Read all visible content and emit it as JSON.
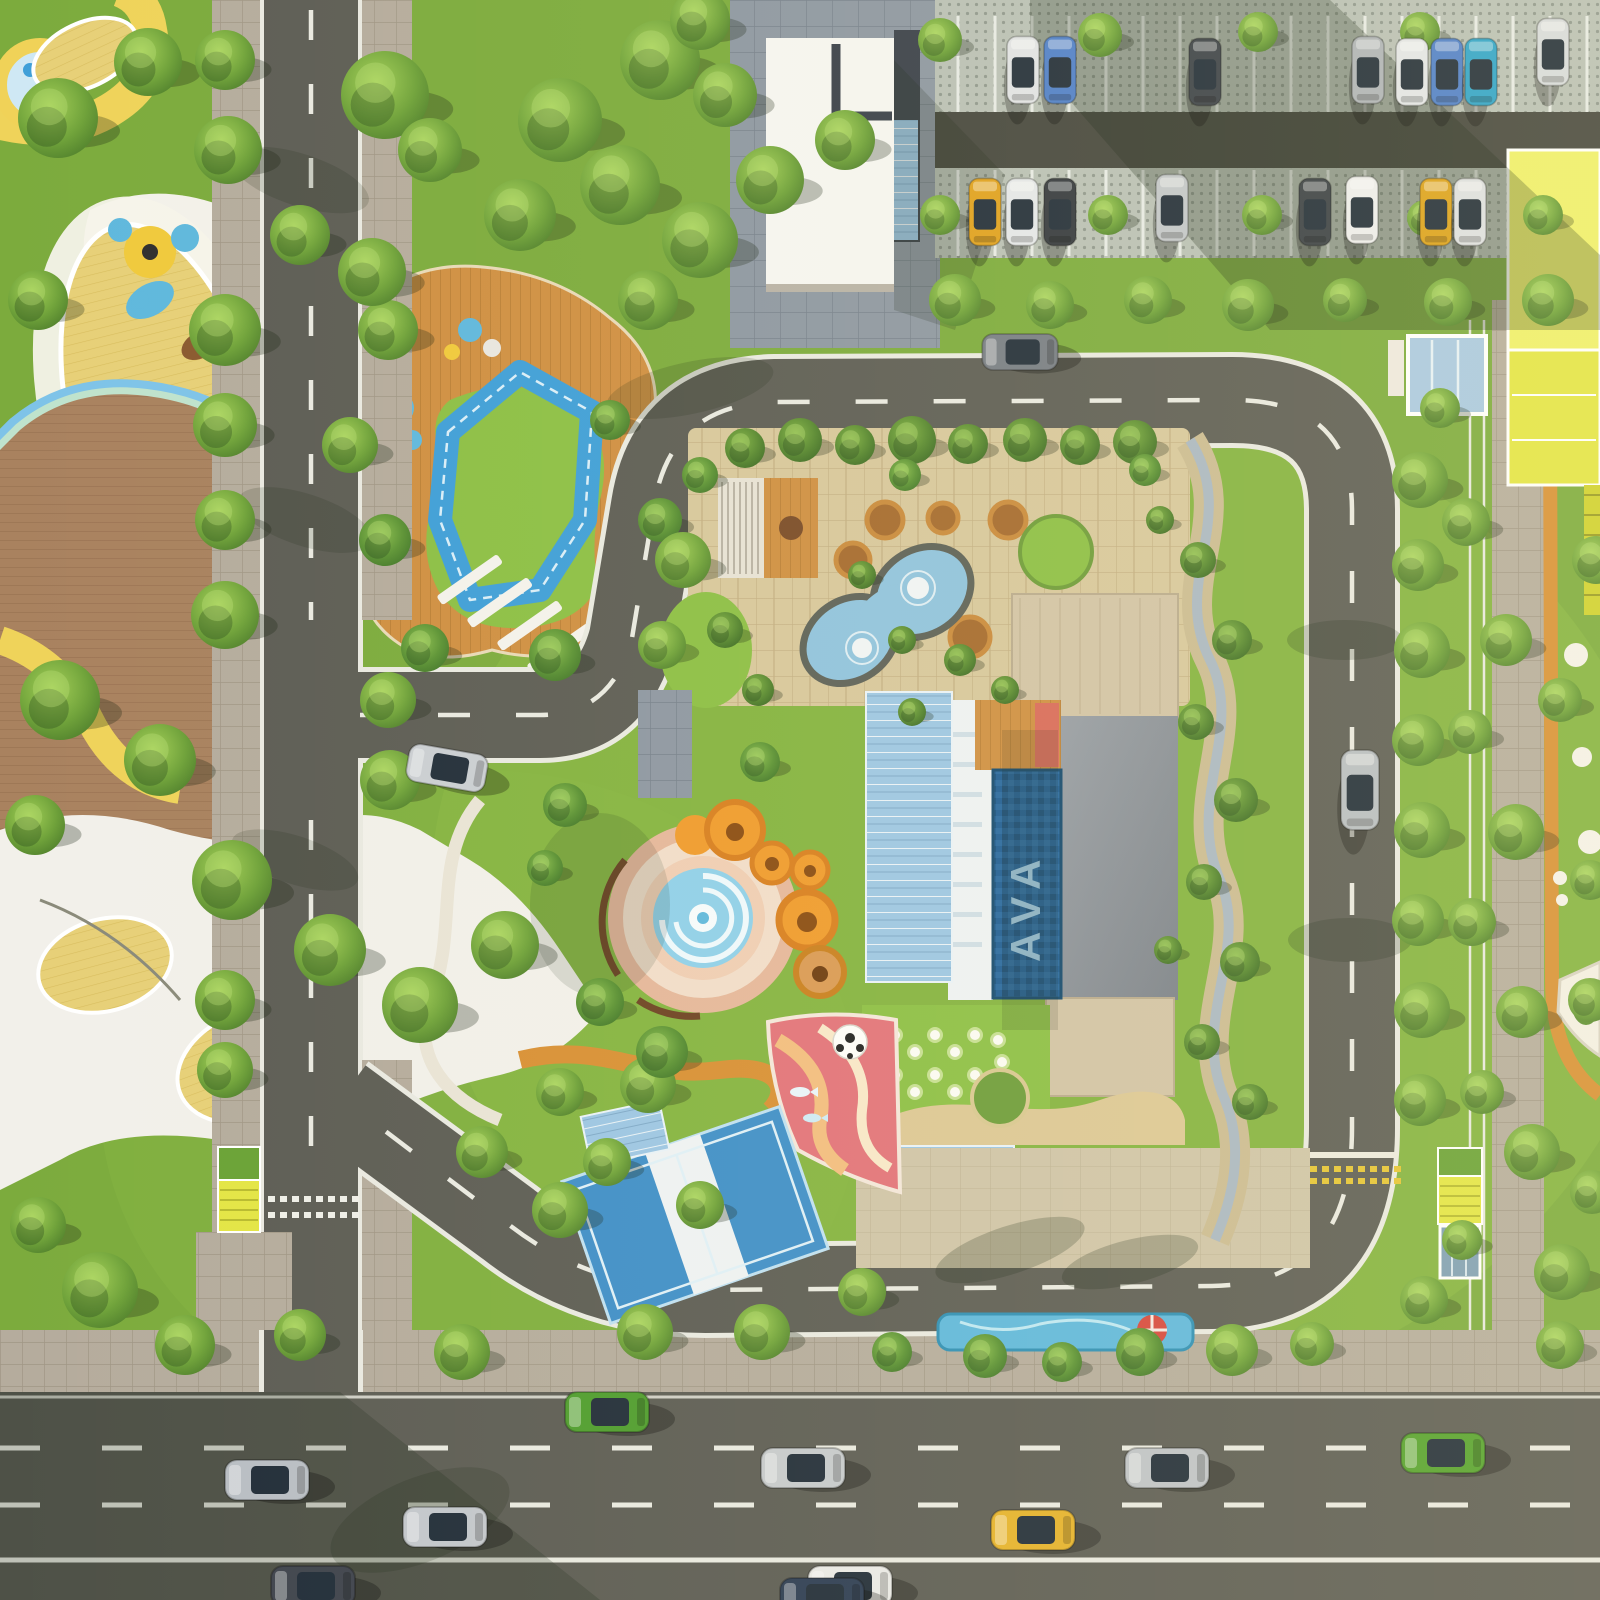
{
  "scene": {
    "type": "aerial-3d-render",
    "description": "Top-down aerial render of a residential amenity block: central clubhouse with lap pool and roof garden, spiral water plaza with orange canopies, kids playgrounds, sports court, loop road, street parking and a multi-lane highway at the bottom"
  },
  "pool": {
    "logo_text": "AVA"
  },
  "palette": {
    "grass": "#7cab3d",
    "grassLight": "#93c24a",
    "grassDark": "#55832e",
    "lawnBright": "#8cbf45",
    "asphalt": "#5d5d55",
    "asphaltDark": "#45463e",
    "roadLine": "#e9e9e1",
    "sidewalk": "#b5ac9d",
    "sidewalkLine": "#a09685",
    "coolPaver": "#8d97a2",
    "coolPaverLine": "#76808c",
    "permPaver": "#b9c0b6",
    "permDot": "#8f978e",
    "terrace": "#d7c79c",
    "terraceLine": "#c2ad81",
    "plaza": "#cfc4a8",
    "wood": "#cf8f42",
    "woodLine": "#b37a33",
    "deckBrown": "#a9825f",
    "deckLine": "#997252",
    "yellowWood": "#e7d078",
    "yellowWoodLine": "#d8bd5e",
    "white": "#f3f1ea",
    "poolDark": "#1e5d94",
    "poolMid": "#3f8fc9",
    "poolLight": "#8fc3de",
    "aqua": "#5fb8dd",
    "glass": "#9cc6e4",
    "trackBlue": "#3f9fd8",
    "orange": "#ef9b2d",
    "orangeDeep": "#d87f1f",
    "jog": "#d89035",
    "pinkRing": "#e5b79b",
    "pinkPale": "#f1ddca",
    "pinkDeep": "#e2737a",
    "sand": "#dcc795",
    "yellowPath": "#efd35a",
    "mint": "#bfe3cd",
    "canopyYellow": "#e3e545",
    "roofDark": "#39404a",
    "roofGray": "#8a9099",
    "roofBeige": "#d2c3a6",
    "red": "#d6483e"
  },
  "trees": [
    [
      58,
      118,
      40,
      0
    ],
    [
      148,
      62,
      34,
      0
    ],
    [
      38,
      300,
      30,
      0
    ],
    [
      225,
      60,
      30,
      0
    ],
    [
      228,
      150,
      34,
      0
    ],
    [
      385,
      95,
      44,
      0
    ],
    [
      300,
      235,
      30,
      0
    ],
    [
      225,
      330,
      36,
      0
    ],
    [
      388,
      330,
      30,
      0
    ],
    [
      225,
      425,
      32,
      0
    ],
    [
      225,
      520,
      30,
      0
    ],
    [
      385,
      540,
      26,
      2
    ],
    [
      225,
      615,
      34,
      0
    ],
    [
      60,
      700,
      40,
      0
    ],
    [
      160,
      760,
      36,
      0
    ],
    [
      35,
      825,
      30,
      0
    ],
    [
      232,
      880,
      40,
      0
    ],
    [
      330,
      950,
      36,
      0
    ],
    [
      225,
      1000,
      30,
      0
    ],
    [
      388,
      700,
      28,
      0
    ],
    [
      390,
      780,
      30,
      0
    ],
    [
      225,
      1070,
      28,
      0
    ],
    [
      100,
      1290,
      38,
      0
    ],
    [
      185,
      1345,
      30,
      0
    ],
    [
      38,
      1225,
      28,
      0
    ],
    [
      300,
      1335,
      26,
      0
    ],
    [
      420,
      1005,
      38,
      0
    ],
    [
      505,
      945,
      34,
      0
    ],
    [
      660,
      60,
      40,
      0
    ],
    [
      560,
      120,
      42,
      0
    ],
    [
      620,
      185,
      40,
      0
    ],
    [
      700,
      240,
      38,
      0
    ],
    [
      770,
      180,
      34,
      0
    ],
    [
      845,
      140,
      30,
      0
    ],
    [
      725,
      95,
      32,
      0
    ],
    [
      520,
      215,
      36,
      0
    ],
    [
      430,
      150,
      32,
      0
    ],
    [
      372,
      272,
      34,
      0
    ],
    [
      350,
      445,
      28,
      0
    ],
    [
      425,
      648,
      24,
      2
    ],
    [
      555,
      655,
      26,
      2
    ],
    [
      648,
      300,
      30,
      0
    ],
    [
      610,
      420,
      20,
      2
    ],
    [
      660,
      520,
      22,
      2
    ],
    [
      940,
      40,
      22,
      0
    ],
    [
      940,
      215,
      20,
      0
    ],
    [
      1100,
      35,
      22,
      0
    ],
    [
      1108,
      215,
      20,
      0
    ],
    [
      1258,
      32,
      20,
      0
    ],
    [
      1262,
      215,
      20,
      0
    ],
    [
      1420,
      32,
      20,
      0
    ],
    [
      1425,
      218,
      18,
      0
    ],
    [
      1543,
      215,
      20,
      0
    ],
    [
      955,
      300,
      26,
      0
    ],
    [
      1050,
      305,
      24,
      0
    ],
    [
      1148,
      300,
      24,
      0
    ],
    [
      1248,
      305,
      26,
      0
    ],
    [
      1345,
      300,
      22,
      0
    ],
    [
      1448,
      302,
      24,
      0
    ],
    [
      1548,
      300,
      26,
      0
    ],
    [
      700,
      20,
      30,
      0
    ],
    [
      745,
      448,
      20,
      1
    ],
    [
      800,
      440,
      22,
      1
    ],
    [
      855,
      445,
      20,
      1
    ],
    [
      912,
      440,
      24,
      1
    ],
    [
      968,
      444,
      20,
      1
    ],
    [
      1025,
      440,
      22,
      1
    ],
    [
      1080,
      445,
      20,
      1
    ],
    [
      1135,
      442,
      22,
      1
    ],
    [
      683,
      560,
      28,
      0
    ],
    [
      662,
      645,
      24,
      0
    ],
    [
      700,
      475,
      18,
      2
    ],
    [
      648,
      1085,
      28,
      0
    ],
    [
      607,
      1162,
      24,
      0
    ],
    [
      700,
      1205,
      24,
      0
    ],
    [
      560,
      1210,
      28,
      0
    ],
    [
      645,
      1332,
      28,
      0
    ],
    [
      762,
      1332,
      28,
      0
    ],
    [
      862,
      1292,
      24,
      0
    ],
    [
      560,
      1092,
      24,
      0
    ],
    [
      482,
      1152,
      26,
      0
    ],
    [
      905,
      475,
      16,
      2
    ],
    [
      1145,
      470,
      16,
      2
    ],
    [
      1198,
      560,
      18,
      1
    ],
    [
      1232,
      640,
      20,
      1
    ],
    [
      1196,
      722,
      18,
      1
    ],
    [
      1236,
      800,
      22,
      1
    ],
    [
      1204,
      882,
      18,
      1
    ],
    [
      1240,
      962,
      20,
      1
    ],
    [
      1202,
      1042,
      18,
      1
    ],
    [
      1250,
      1102,
      18,
      1
    ],
    [
      1160,
      520,
      14,
      1
    ],
    [
      1168,
      950,
      14,
      1
    ],
    [
      462,
      1352,
      28,
      0
    ],
    [
      985,
      1356,
      22,
      2
    ],
    [
      1062,
      1362,
      20,
      2
    ],
    [
      1140,
      1352,
      24,
      2
    ],
    [
      1232,
      1350,
      26,
      0
    ],
    [
      1312,
      1344,
      22,
      0
    ],
    [
      892,
      1352,
      20,
      2
    ],
    [
      1420,
      480,
      28,
      0
    ],
    [
      1418,
      565,
      26,
      0
    ],
    [
      1422,
      650,
      28,
      0
    ],
    [
      1418,
      740,
      26,
      0
    ],
    [
      1422,
      830,
      28,
      0
    ],
    [
      1418,
      920,
      26,
      0
    ],
    [
      1422,
      1010,
      28,
      0
    ],
    [
      1420,
      1100,
      26,
      0
    ],
    [
      1466,
      522,
      24,
      0
    ],
    [
      1506,
      640,
      26,
      0
    ],
    [
      1470,
      732,
      22,
      0
    ],
    [
      1516,
      832,
      28,
      0
    ],
    [
      1472,
      922,
      24,
      0
    ],
    [
      1522,
      1012,
      26,
      0
    ],
    [
      1482,
      1092,
      22,
      0
    ],
    [
      1532,
      1152,
      28,
      0
    ],
    [
      1424,
      1300,
      24,
      0
    ],
    [
      1562,
      1272,
      28,
      0
    ],
    [
      1592,
      1192,
      22,
      0
    ],
    [
      1560,
      700,
      22,
      0
    ],
    [
      1596,
      560,
      24,
      0
    ],
    [
      1590,
      880,
      20,
      0
    ],
    [
      1440,
      408,
      20,
      0
    ],
    [
      1590,
      1000,
      22,
      0
    ],
    [
      1462,
      1240,
      20,
      0
    ],
    [
      1560,
      1345,
      24,
      0
    ],
    [
      600,
      1002,
      24,
      2
    ],
    [
      662,
      1052,
      26,
      2
    ],
    [
      565,
      805,
      22,
      2
    ],
    [
      760,
      762,
      20,
      2
    ],
    [
      545,
      868,
      18,
      2
    ],
    [
      725,
      630,
      18,
      1
    ],
    [
      758,
      690,
      16,
      1
    ],
    [
      902,
      640,
      14,
      1
    ],
    [
      960,
      660,
      16,
      1
    ],
    [
      1005,
      690,
      14,
      1
    ],
    [
      862,
      575,
      14,
      1
    ],
    [
      912,
      712,
      14,
      1
    ]
  ],
  "cars": {
    "items": [
      [
        607,
        1412,
        0,
        1,
        "#4f9d2f"
      ],
      [
        267,
        1480,
        0,
        1,
        "#b9bec4"
      ],
      [
        445,
        1527,
        0,
        1,
        "#c3c7cc"
      ],
      [
        313,
        1586,
        0,
        1,
        "#40454e"
      ],
      [
        803,
        1468,
        0,
        1,
        "#c6cacd"
      ],
      [
        1033,
        1530,
        0,
        1,
        "#e5b22c"
      ],
      [
        850,
        1586,
        0,
        1,
        "#e9e9e7"
      ],
      [
        1167,
        1468,
        0,
        1,
        "#bfc3c8"
      ],
      [
        1443,
        1453,
        0,
        1,
        "#55a22e"
      ],
      [
        822,
        1598,
        0,
        1,
        "#2d3d54"
      ],
      [
        447,
        768,
        10,
        0.95,
        "#caced3"
      ],
      [
        1020,
        352,
        0,
        0.9,
        "#777d85"
      ],
      [
        1360,
        790,
        90,
        0.95,
        "#b8bdc2"
      ],
      [
        1023,
        70,
        90,
        0.8,
        "#e0e3e6"
      ],
      [
        1060,
        70,
        90,
        0.8,
        "#4f7fc9"
      ],
      [
        1205,
        72,
        90,
        0.8,
        "#3c4249"
      ],
      [
        1368,
        70,
        90,
        0.8,
        "#aeb3b8"
      ],
      [
        1412,
        72,
        90,
        0.8,
        "#e2e5e8"
      ],
      [
        1447,
        72,
        90,
        0.8,
        "#4f7fc9"
      ],
      [
        1481,
        72,
        90,
        0.8,
        "#2fa3c9"
      ],
      [
        1553,
        52,
        90,
        0.8,
        "#d7dadd"
      ],
      [
        985,
        212,
        90,
        0.8,
        "#dfa11f"
      ],
      [
        1022,
        212,
        90,
        0.8,
        "#e4e7ea"
      ],
      [
        1060,
        212,
        90,
        0.8,
        "#34393f"
      ],
      [
        1172,
        208,
        90,
        0.8,
        "#c2c6ca"
      ],
      [
        1315,
        212,
        90,
        0.8,
        "#3a4046"
      ],
      [
        1362,
        210,
        90,
        0.8,
        "#ededee"
      ],
      [
        1436,
        212,
        90,
        0.8,
        "#dca11c"
      ],
      [
        1470,
        212,
        90,
        0.8,
        "#dddfe2"
      ]
    ]
  },
  "parking": {
    "x0": 958,
    "x1": 1592,
    "step": 37,
    "rows": [
      [
        16,
        112
      ],
      [
        170,
        256
      ]
    ],
    "line_color": "#e7eae6"
  },
  "crosswalks": {
    "left_road": {
      "x0": 268,
      "x1": 352,
      "step": 12,
      "rows": [
        1196,
        1212
      ],
      "color": "#efefe8"
    },
    "right_road": {
      "x0": 1310,
      "x1": 1396,
      "step": 12,
      "rows": [
        1166,
        1178
      ],
      "color": "#e5c435"
    }
  },
  "sphere_seats": [
    [
      895,
      1035
    ],
    [
      915,
      1052
    ],
    [
      935,
      1035
    ],
    [
      955,
      1052
    ],
    [
      975,
      1035
    ],
    [
      895,
      1075
    ],
    [
      915,
      1092
    ],
    [
      935,
      1075
    ],
    [
      955,
      1092
    ],
    [
      975,
      1075
    ],
    [
      998,
      1040
    ],
    [
      1002,
      1062
    ]
  ],
  "counts": {
    "trees": 137,
    "cars": 29
  }
}
